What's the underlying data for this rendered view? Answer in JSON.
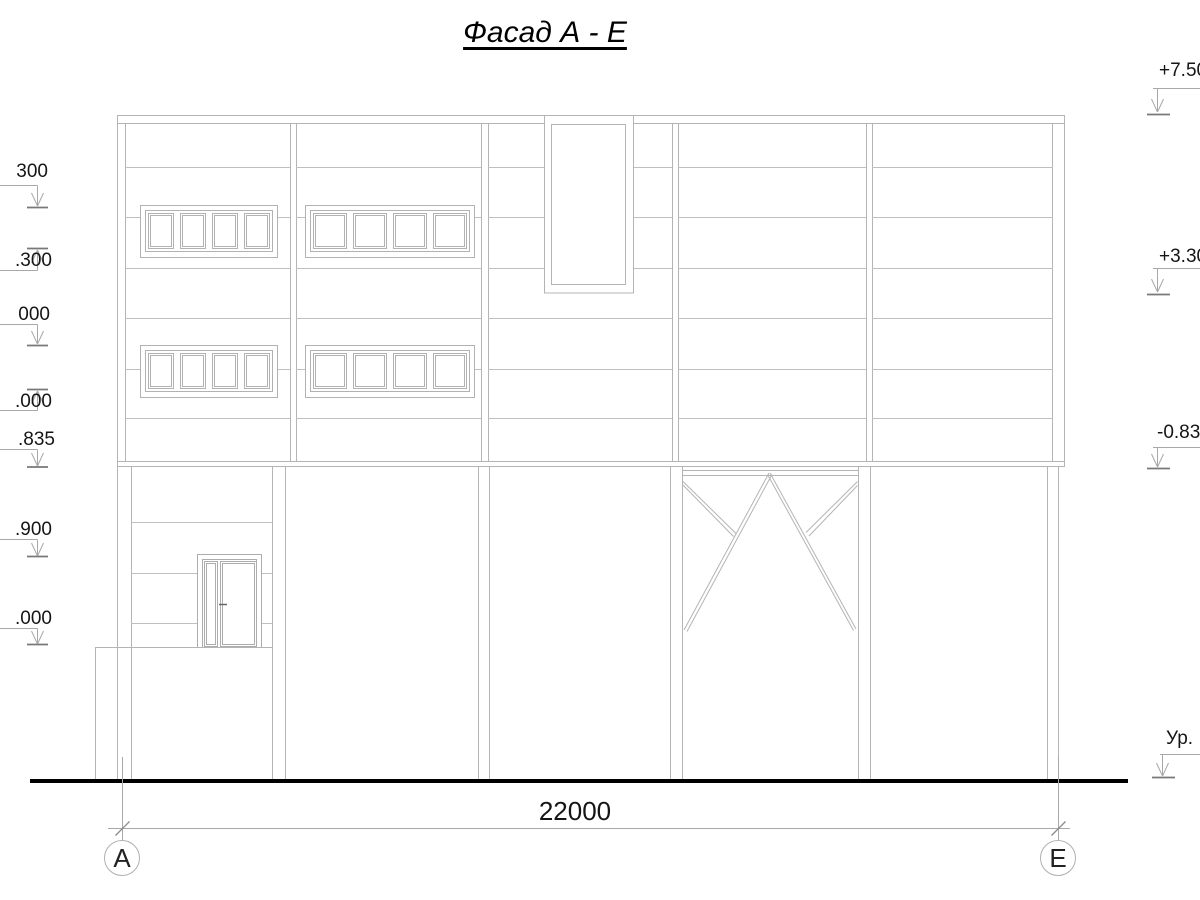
{
  "title": "Фасад А - Е",
  "dimension": {
    "total": "22000"
  },
  "axes": {
    "left": "А",
    "right": "Е"
  },
  "elevation_marks_left": {
    "m1": "300",
    "m2": ".300",
    "m3": "000",
    "m4": ".000",
    "m5": ".835",
    "m6": ".900",
    "m7": ".000"
  },
  "elevation_marks_right": {
    "r1": "+7.50",
    "r2": "+3.30",
    "r3": "-0.83",
    "r4": "Ур."
  },
  "colors": {
    "drawing_line": "#b9b9b9",
    "marker_line": "#a8a8a8",
    "text": "#151515",
    "ground_line": "#000000"
  }
}
